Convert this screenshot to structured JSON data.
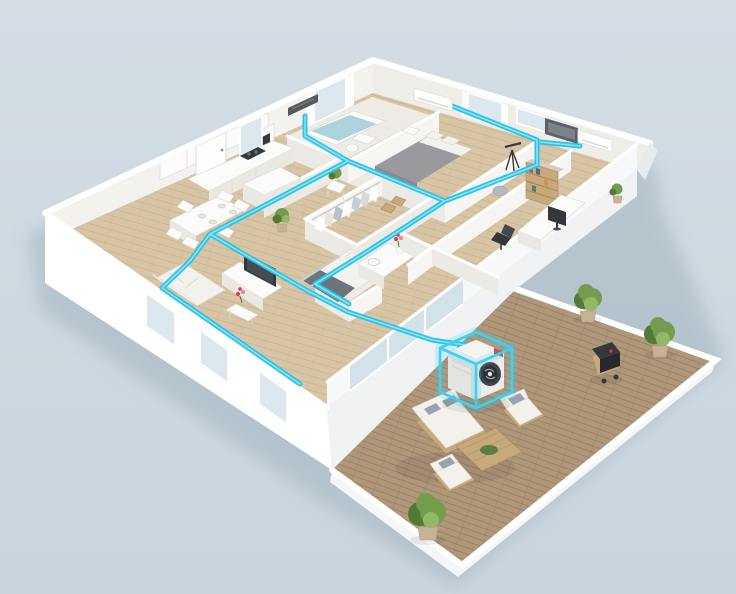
{
  "scene": {
    "setting": "isometric-3d-floor-plan-render",
    "background": {
      "top": "#d6dfe6",
      "bottom": "#c8d4dc"
    },
    "palette": {
      "wall": "#ffffff",
      "wall_face": "#f6f5f2",
      "wall_side": "#eceae5",
      "wall_inner_left": "#f4f2ee",
      "wall_inner_right": "#efede8",
      "slab": "#f0f2f4",
      "floor_wood": "#d7c5a6",
      "floor_plank": "#c3ae8d",
      "terrace_wood": "#b0977a",
      "terrace_plank": "#8d775c",
      "duct": "#2fc2e4",
      "duct_core": "#8ceaf9",
      "highlight": "#3fd0f0",
      "glass": "#cfdfe7",
      "window_glass": "#dde8ee",
      "bed_gray": "#9a9a9e",
      "linen": "#f3f2ee",
      "furn_white": "#fbfbf9",
      "furn_shade": "#e9e8e3",
      "wood_furn": "#c8a97b",
      "wood_furn_dark": "#a9885c",
      "plant": "#749c4f",
      "plant_dark": "#527a36",
      "pot": "#c8b295",
      "dark": "#34383d",
      "gray_cushion": "#9aa3ab",
      "cushion": "#f3f1ec",
      "accent_red": "#e03a42",
      "water": "#aed3de",
      "shadow": "#9eb0bd"
    },
    "hvac": {
      "outdoor_unit_count": 1,
      "indoor_wall_unit_count": 2,
      "concealed_vent_count": 1,
      "duct_color": "#2fc2e4",
      "highlight_color": "#3fd0f0",
      "outdoor_unit_badge_color": "#e03a42"
    },
    "rooms": [
      "kitchen",
      "dining-area",
      "living-room",
      "master-bedroom",
      "bathroom",
      "walk-in-closet",
      "hallway",
      "bedroom-2",
      "home-office",
      "bathroom-2",
      "terrace"
    ],
    "furniture": [
      "kitchen-cabinets",
      "kitchen-island",
      "dining-table",
      "dining-chairs",
      "bathtub",
      "master-bed",
      "nightstand",
      "closet-clothes",
      "tv-console",
      "tv",
      "sofa",
      "coffee-table",
      "bed",
      "desk",
      "monitor",
      "office-chair",
      "bookshelf",
      "vanity",
      "outdoor-sofa",
      "outdoor-armchair",
      "outdoor-side-chair",
      "outdoor-coffee-table",
      "bbq-grill",
      "potted-plants"
    ]
  }
}
